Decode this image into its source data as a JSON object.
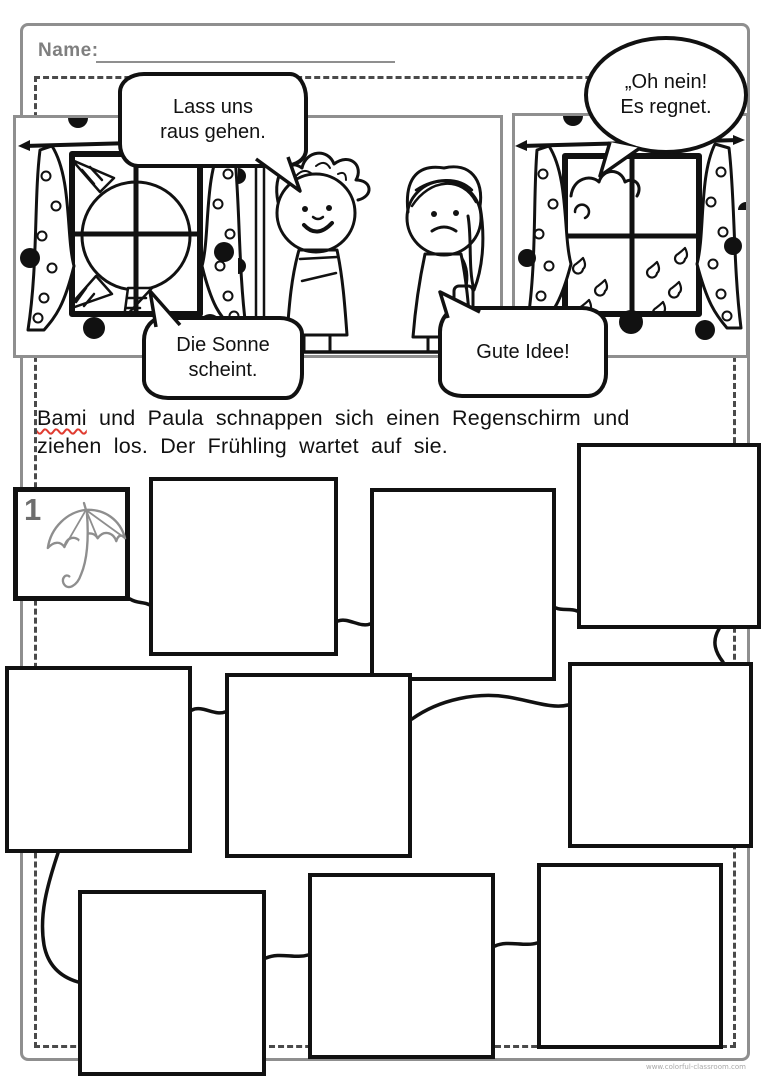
{
  "header": {
    "name_label": "Name:"
  },
  "speech_bubbles": {
    "lass_uns": {
      "line1": "Lass uns",
      "line2": "raus gehen."
    },
    "oh_nein": {
      "line1": "„Oh nein!",
      "line2": "Es regnet."
    },
    "die_sonne": {
      "line1": "Die Sonne",
      "line2": "scheint."
    },
    "gute_idee": {
      "line1": "Gute Idee!"
    }
  },
  "story": {
    "marked_word": "Bami",
    "line1_rest": " und Paula schnappen sich einen Regenschirm und",
    "line2": "ziehen los. Der Frühling wartet auf sie."
  },
  "sequence": {
    "start_label": "1",
    "start_icon": "umbrella-icon",
    "empty_box_count": 9
  },
  "scene": {
    "left_panel_icon": "window-sun-icon",
    "right_panel_icon": "window-rain-icon",
    "figures": [
      "boy-figure",
      "girl-figure"
    ]
  },
  "footer": {
    "watermark": "www.colorful-classroom.com"
  },
  "colors": {
    "ink": "#111111",
    "frame_gray": "#8f8f8f",
    "muted_gray": "#7f7f7f",
    "umbrella_gray": "#8e8e8e",
    "spellcheck_red": "#e03c31"
  }
}
